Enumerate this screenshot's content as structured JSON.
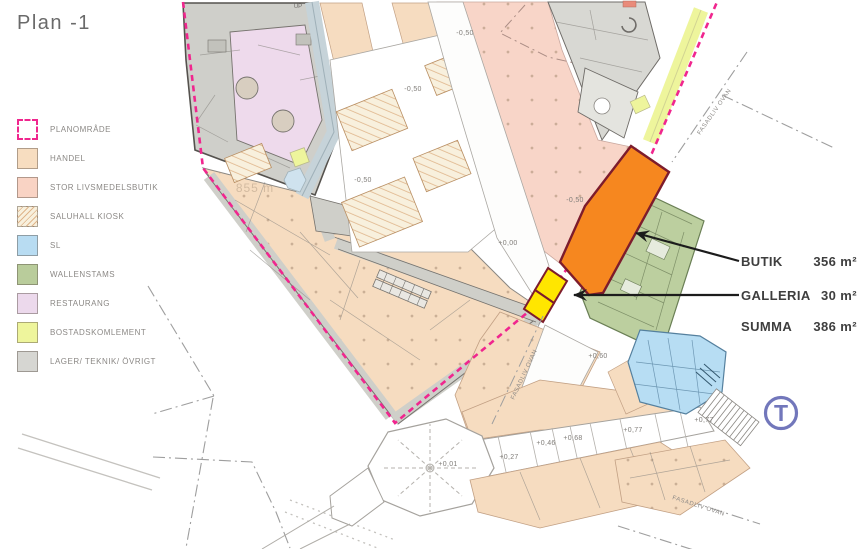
{
  "title": "Plan -1",
  "legend": {
    "items": [
      {
        "label": "PLANOMRÅDE",
        "color": "#ffffff",
        "border": "#f0268e",
        "style": "dashed-outline"
      },
      {
        "label": "HANDEL",
        "color": "#f7ddc0"
      },
      {
        "label": "STOR LIVSMEDELSBUTIK",
        "color": "#f9d3c4"
      },
      {
        "label": "SALUHALL KIOSK",
        "color": "#faf2e2",
        "style": "hatched"
      },
      {
        "label": "SL",
        "color": "#b8dcf2"
      },
      {
        "label": "WALLENSTAMS",
        "color": "#b9cc9b"
      },
      {
        "label": "RESTAURANG",
        "color": "#ecd9ec"
      },
      {
        "label": "BOSTADSKOMLEMENT",
        "color": "#eef59c"
      },
      {
        "label": "LAGER/ TEKNIK/ ÖVRIGT",
        "color": "#d6d6d2"
      }
    ]
  },
  "annotations": {
    "rows": [
      {
        "label": "BUTIK",
        "value": "356 m²"
      },
      {
        "label": "GALLERIA",
        "value": "30 m²"
      },
      {
        "label": "SUMMA",
        "value": "386 m²"
      }
    ]
  },
  "map": {
    "up_label": "UP",
    "ghost_area_label": "855 m",
    "fasadliv_label": "FASADLIV OVAN",
    "metro_symbol": "T",
    "level_labels": [
      "-0,50",
      "-0,50",
      "-0,50",
      "-0,50",
      "+0,00",
      "+0,60",
      "+0,01",
      "+0,27",
      "+0,46",
      "+0,68",
      "+0,77",
      "+0,77"
    ]
  },
  "colors": {
    "boundary": "#f0268e",
    "highlight_butik": "#f6871f",
    "highlight_galleria": "#ffe600",
    "highlight_outline": "#7d1c2c",
    "handel": "#f6dcc0",
    "stor_livsmedelsbutik": "#f8d5c8",
    "sl": "#b7ddf3",
    "wallenstams": "#bccf9f",
    "restaurang": "#eedaec",
    "bostadskomlement": "#eef59c",
    "lager": "#d2d2cc",
    "metro": "#7277bb"
  }
}
